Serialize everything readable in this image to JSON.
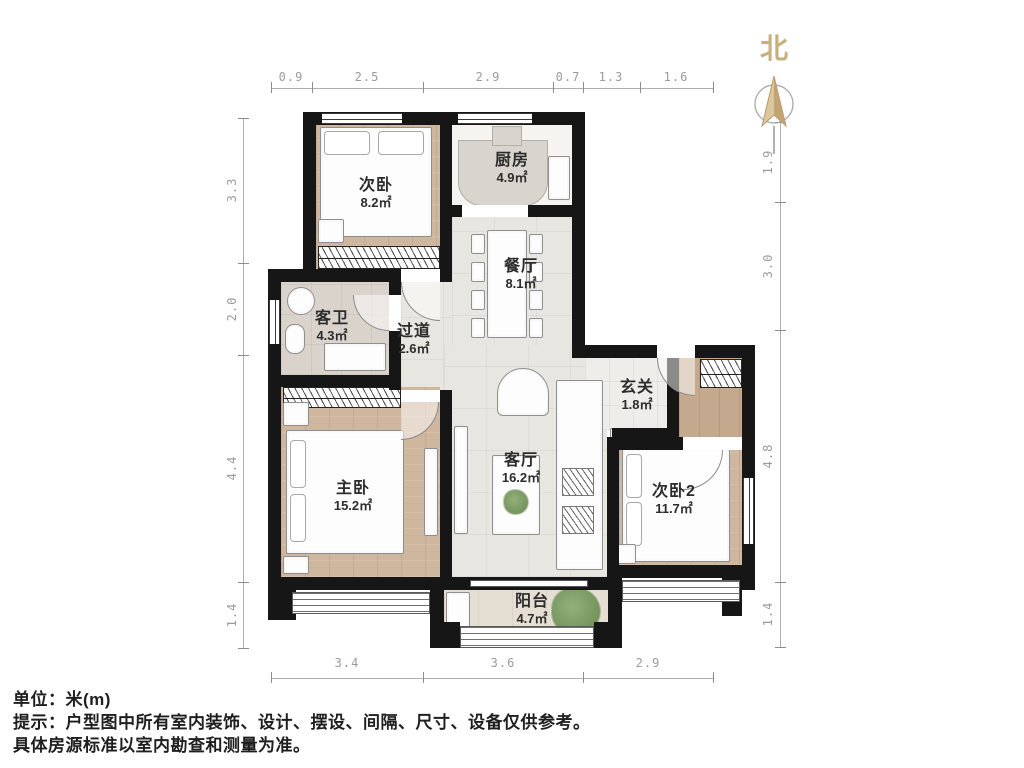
{
  "north": {
    "label": "北"
  },
  "rooms": [
    {
      "name": "次卧",
      "area": "8.2㎡"
    },
    {
      "name": "厨房",
      "area": "4.9㎡"
    },
    {
      "name": "餐厅",
      "area": "8.1㎡"
    },
    {
      "name": "客卫",
      "area": "4.3㎡"
    },
    {
      "name": "过道",
      "area": "2.6㎡"
    },
    {
      "name": "玄关",
      "area": "1.8㎡"
    },
    {
      "name": "主卧",
      "area": "15.2㎡"
    },
    {
      "name": "客厅",
      "area": "16.2㎡"
    },
    {
      "name": "次卧2",
      "area": "11.7㎡"
    },
    {
      "name": "阳台",
      "area": "4.7㎡"
    }
  ],
  "dimensions": {
    "top": [
      "0.9",
      "2.5",
      "2.9",
      "0.7",
      "1.3",
      "1.6"
    ],
    "bottom": [
      "3.4",
      "3.6",
      "2.9"
    ],
    "left": [
      "3.3",
      "2.0",
      "4.4",
      "1.4"
    ],
    "right": [
      "1.9",
      "3.0",
      "4.8",
      "1.4"
    ]
  },
  "footer": {
    "unit": "单位：米(m)",
    "tip": "提示：户型图中所有室内装饰、设计、摆设、间隔、尺寸、设备仅供参考。",
    "note": "具体房源标准以室内勘查和测量为准。"
  },
  "colors": {
    "wall": "#161616",
    "wood_floor": "#cfb69e",
    "tile_floor": "#e8e6e1",
    "north_accent": "#c8b07e",
    "dim_text": "#9b9b9b",
    "plant_green": "#67894f"
  }
}
